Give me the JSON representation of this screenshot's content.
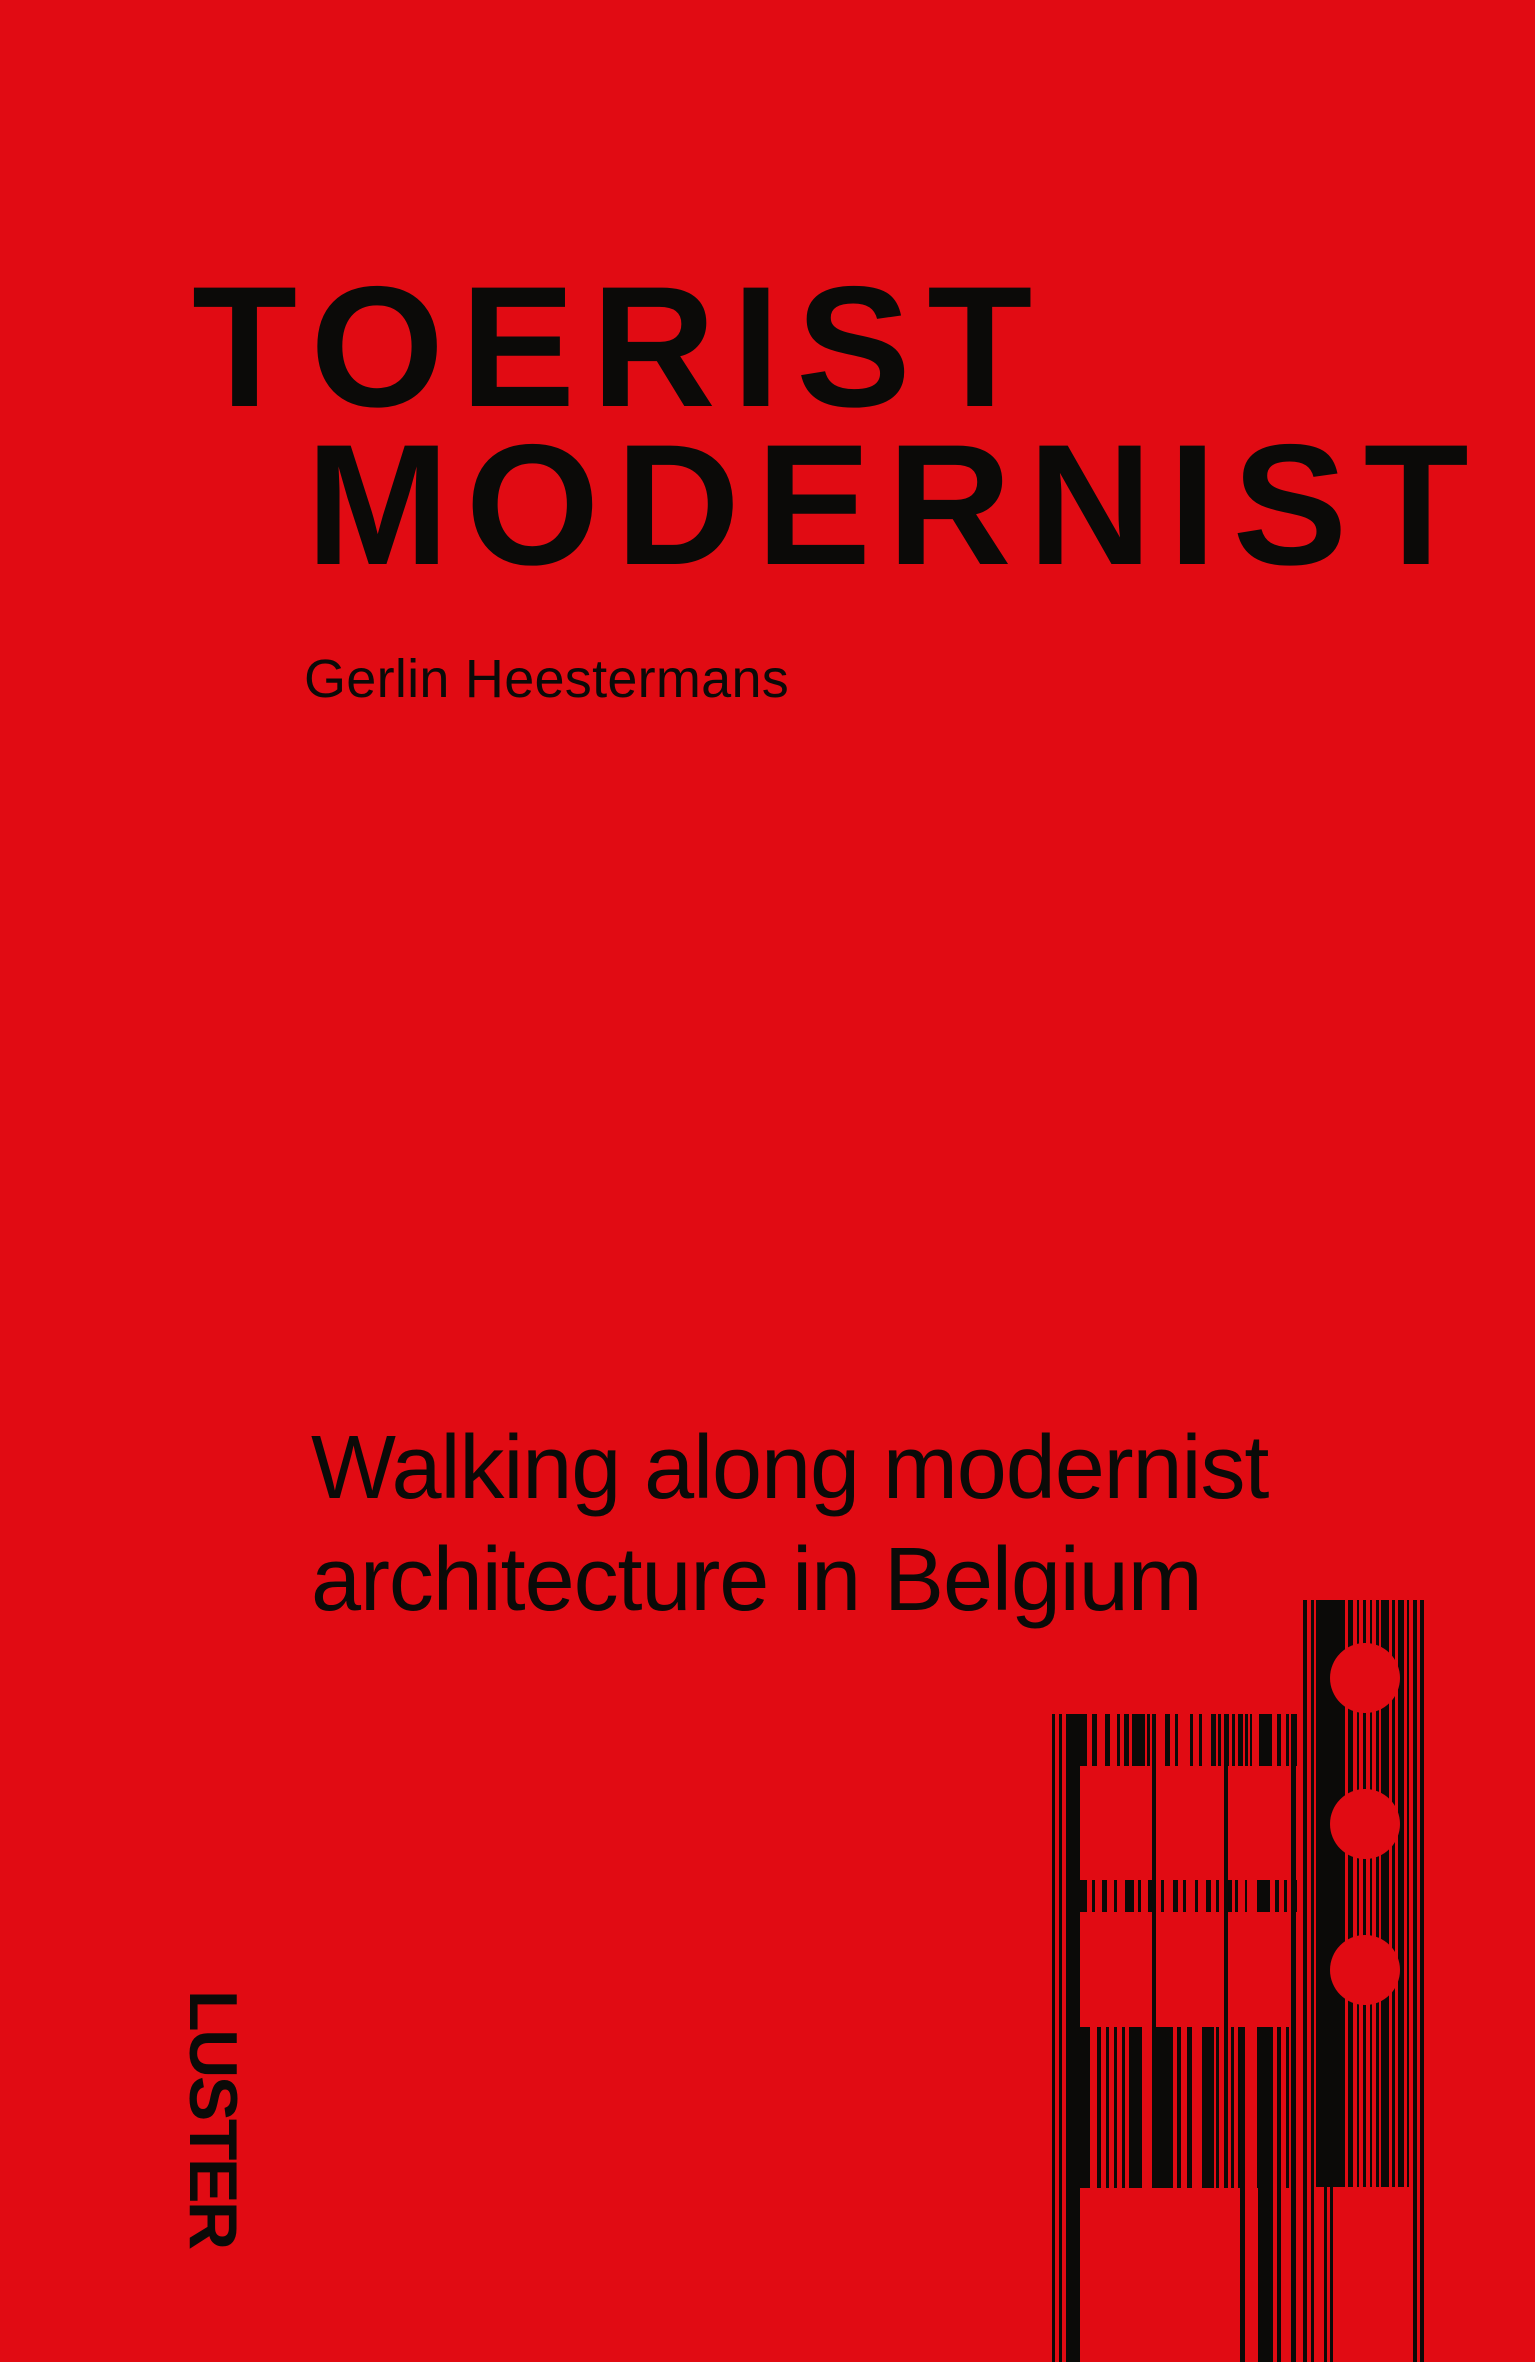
{
  "cover": {
    "title_line1": "TOERIST",
    "title_line2": "MODERNIST",
    "author": "Gerlin Heestermans",
    "subtitle_line1": "Walking along modernist",
    "subtitle_line2": "architecture in Belgium",
    "publisher": "LUSTER"
  },
  "colors": {
    "background": "#e10b13",
    "ink": "#0b0a08"
  },
  "graphic": {
    "name": "barcode-building-artwork",
    "columns": [
      {
        "x": 1052,
        "y": 1714,
        "w": 3,
        "h": 648
      },
      {
        "x": 1059,
        "y": 1714,
        "w": 3,
        "h": 648
      },
      {
        "x": 1066,
        "y": 1714,
        "w": 14,
        "h": 648
      },
      {
        "x": 1152,
        "y": 1714,
        "w": 4,
        "h": 474
      },
      {
        "x": 1224,
        "y": 1714,
        "w": 4,
        "h": 474
      },
      {
        "x": 1291,
        "y": 1714,
        "w": 5,
        "h": 648
      },
      {
        "x": 1240,
        "y": 2027,
        "w": 5,
        "h": 335
      },
      {
        "x": 1258,
        "y": 2027,
        "w": 15,
        "h": 335
      },
      {
        "x": 1277,
        "y": 2027,
        "w": 4,
        "h": 335
      },
      {
        "x": 1303,
        "y": 1600,
        "w": 4,
        "h": 762
      },
      {
        "x": 1311,
        "y": 1600,
        "w": 3,
        "h": 762
      },
      {
        "x": 1324,
        "y": 1600,
        "w": 3,
        "h": 762
      },
      {
        "x": 1330,
        "y": 1600,
        "w": 3,
        "h": 762
      },
      {
        "x": 1413,
        "y": 1600,
        "w": 4,
        "h": 762
      },
      {
        "x": 1420,
        "y": 1600,
        "w": 4,
        "h": 762
      },
      {
        "x": 1316,
        "y": 1600,
        "w": 15,
        "h": 587
      },
      {
        "x": 1333,
        "y": 1600,
        "w": 12,
        "h": 587
      },
      {
        "x": 1348,
        "y": 1600,
        "w": 5,
        "h": 587
      },
      {
        "x": 1357,
        "y": 1600,
        "w": 2,
        "h": 587
      },
      {
        "x": 1363,
        "y": 1600,
        "w": 3,
        "h": 587
      },
      {
        "x": 1370,
        "y": 1600,
        "w": 2,
        "h": 587
      },
      {
        "x": 1376,
        "y": 1600,
        "w": 3,
        "h": 587
      },
      {
        "x": 1381,
        "y": 1600,
        "w": 8,
        "h": 587
      },
      {
        "x": 1392,
        "y": 1600,
        "w": 3,
        "h": 587
      },
      {
        "x": 1398,
        "y": 1600,
        "w": 6,
        "h": 587
      },
      {
        "x": 1407,
        "y": 1600,
        "w": 2,
        "h": 587
      }
    ],
    "bands": [
      {
        "x": 1080,
        "y": 1714,
        "h": 52,
        "bars": [
          [
            0,
            7
          ],
          [
            12,
            5
          ],
          [
            25,
            5
          ],
          [
            37,
            3
          ],
          [
            44,
            5
          ],
          [
            52,
            13
          ],
          [
            67,
            3
          ],
          [
            72,
            4
          ],
          [
            85,
            5
          ],
          [
            95,
            3
          ],
          [
            110,
            3
          ],
          [
            119,
            3
          ],
          [
            131,
            5
          ],
          [
            138,
            3
          ],
          [
            145,
            4
          ],
          [
            152,
            3
          ],
          [
            158,
            5
          ],
          [
            165,
            3
          ],
          [
            170,
            2
          ],
          [
            179,
            13
          ],
          [
            197,
            4
          ],
          [
            206,
            3
          ],
          [
            212,
            5
          ]
        ]
      },
      {
        "x": 1080,
        "y": 1880,
        "h": 32,
        "bars": [
          [
            0,
            7
          ],
          [
            12,
            3
          ],
          [
            22,
            5
          ],
          [
            34,
            3
          ],
          [
            45,
            9
          ],
          [
            58,
            3
          ],
          [
            68,
            5
          ],
          [
            81,
            3
          ],
          [
            93,
            5
          ],
          [
            103,
            3
          ],
          [
            115,
            3
          ],
          [
            126,
            5
          ],
          [
            136,
            3
          ],
          [
            147,
            5
          ],
          [
            155,
            3
          ],
          [
            165,
            2
          ],
          [
            177,
            13
          ],
          [
            195,
            4
          ],
          [
            204,
            3
          ],
          [
            212,
            5
          ]
        ]
      },
      {
        "x": 1080,
        "y": 2027,
        "h": 161,
        "bars": [
          [
            0,
            10
          ],
          [
            17,
            4
          ],
          [
            26,
            3
          ],
          [
            34,
            3
          ],
          [
            42,
            3
          ],
          [
            49,
            13
          ],
          [
            72,
            21
          ],
          [
            97,
            4
          ],
          [
            107,
            5
          ],
          [
            122,
            12
          ],
          [
            136,
            3
          ],
          [
            144,
            3
          ],
          [
            151,
            3
          ],
          [
            158,
            3
          ],
          [
            177,
            16
          ],
          [
            197,
            4
          ],
          [
            206,
            3
          ],
          [
            211,
            5
          ]
        ]
      }
    ],
    "circles": [
      {
        "cx": 1365,
        "cy": 1678,
        "r": 35
      },
      {
        "cx": 1365,
        "cy": 1824,
        "r": 35
      },
      {
        "cx": 1365,
        "cy": 1970,
        "r": 35
      }
    ]
  }
}
